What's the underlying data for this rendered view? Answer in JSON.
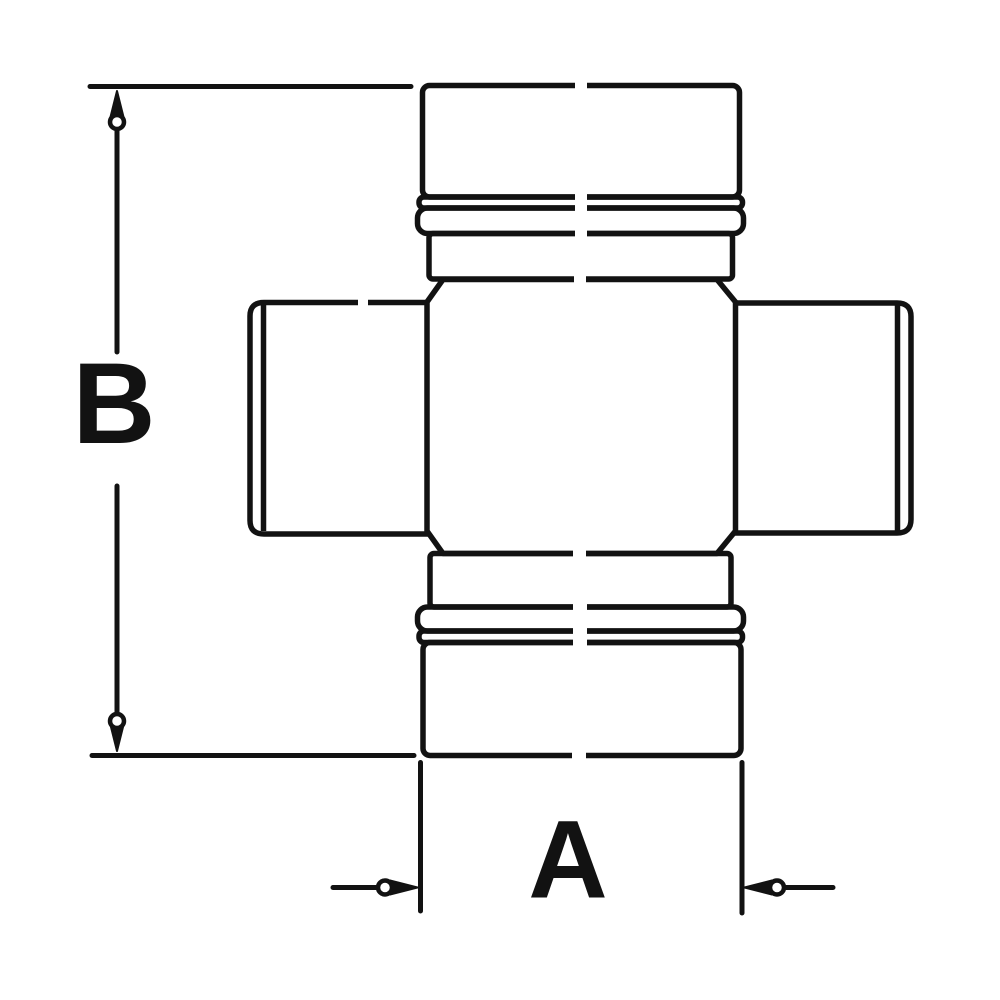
{
  "figure": {
    "subject": "u-joint-cross-technical-drawing",
    "background_color": "#ffffff",
    "line_color": "#121212",
    "dimensions": {
      "vertical_label": "B",
      "horizontal_label": "A"
    }
  }
}
